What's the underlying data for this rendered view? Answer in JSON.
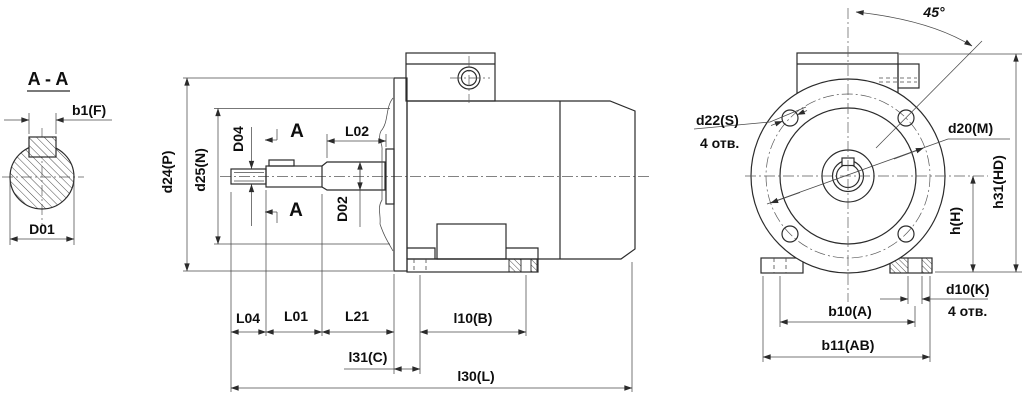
{
  "colors": {
    "background": "#ffffff",
    "outline": "#2b2b2b",
    "dim_line": "#4a4a4a",
    "text": "#0e0e0e"
  },
  "section_view": {
    "title": "A - A",
    "labels": {
      "b1": "b1(F)",
      "d01": "D01"
    }
  },
  "side_view": {
    "labels": {
      "d24": "d24(P)",
      "d25": "d25(N)",
      "d04": "D04",
      "l02": "L02",
      "d02": "D02",
      "section_mark_top": "A",
      "section_mark_bottom": "A",
      "l04": "L04",
      "l01": "L01",
      "l21": "L21",
      "l10": "l10(B)",
      "l31": "l31(C)",
      "l30": "l30(L)"
    }
  },
  "front_view": {
    "labels": {
      "d22": "d22(S)",
      "d22_qty": "4 отв.",
      "d20": "d20(M)",
      "angle": "45°",
      "h": "h(H)",
      "h31": "h31(HD)",
      "d10": "d10(K)",
      "d10_qty": "4 отв.",
      "b10": "b10(A)",
      "b11": "b11(AB)"
    }
  }
}
